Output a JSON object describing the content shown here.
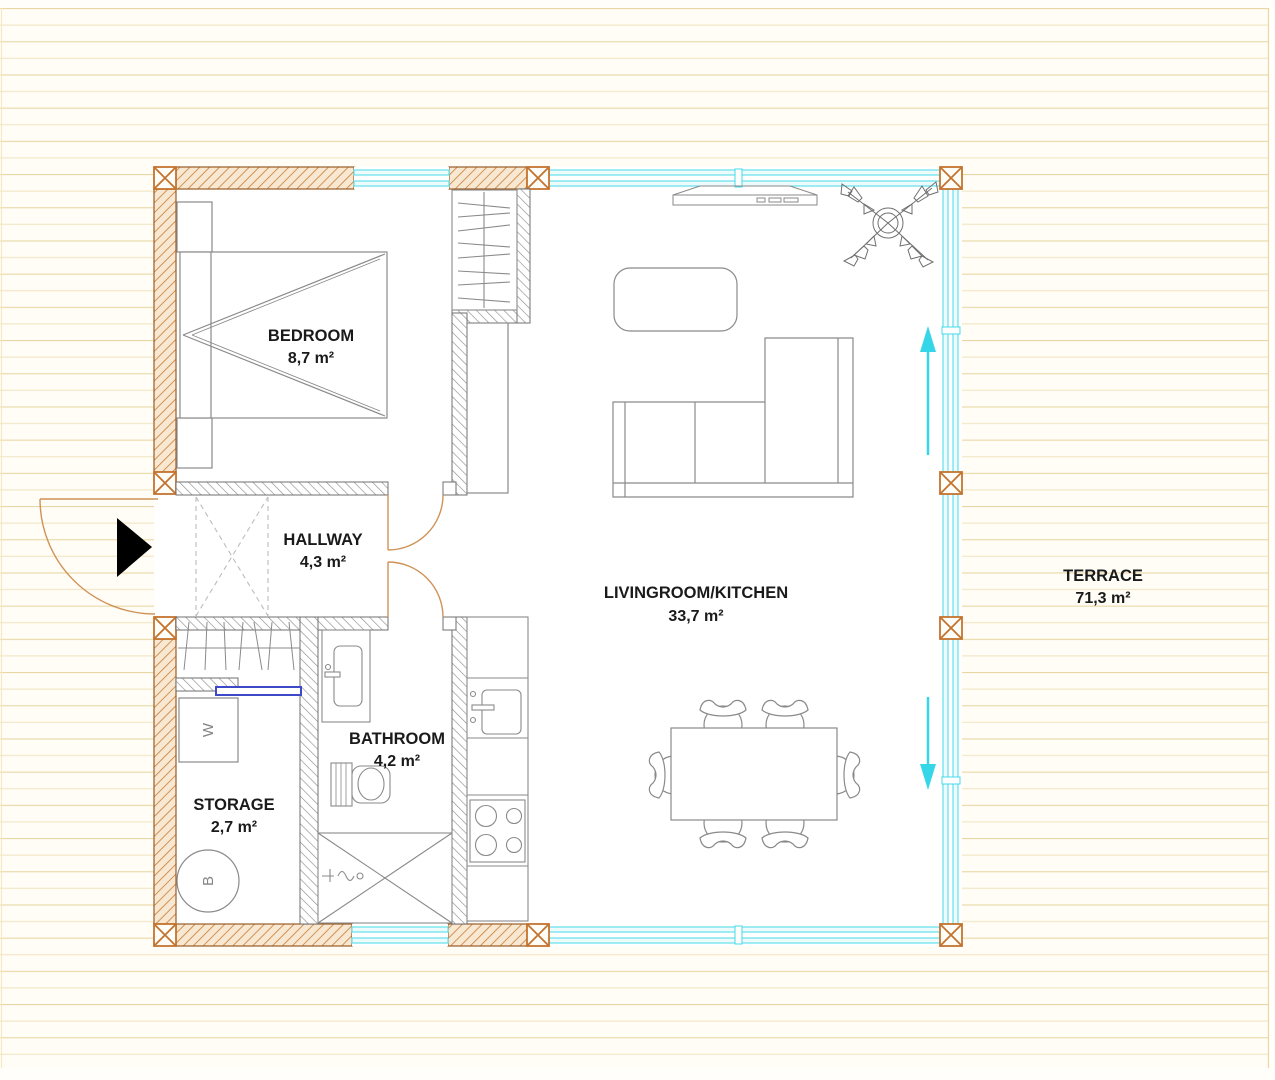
{
  "rooms": {
    "bedroom": {
      "name": "BEDROOM",
      "area": "8,7 m²"
    },
    "hallway": {
      "name": "HALLWAY",
      "area": "4,3 m²"
    },
    "bathroom": {
      "name": "BATHROOM",
      "area": "4,2 m²"
    },
    "storage": {
      "name": "STORAGE",
      "area": "2,7 m²"
    },
    "livingroom": {
      "name": "LIVINGROOM/KITCHEN",
      "area": "33,7 m²"
    },
    "terrace": {
      "name": "TERRACE",
      "area": "71,3 m²"
    }
  },
  "appliances": {
    "washing_machine_label": "W",
    "boiler_label": "B"
  },
  "colors": {
    "deck_line": "#e9d8a6",
    "exterior_wall_hatch": "#c9833f",
    "interior_wall_hatch": "#8f8f8f",
    "glass": "#44d9e8",
    "door_swing": "#cf9257",
    "storage_slider": "#3d49c9",
    "label_text": "#1a1a1a"
  }
}
